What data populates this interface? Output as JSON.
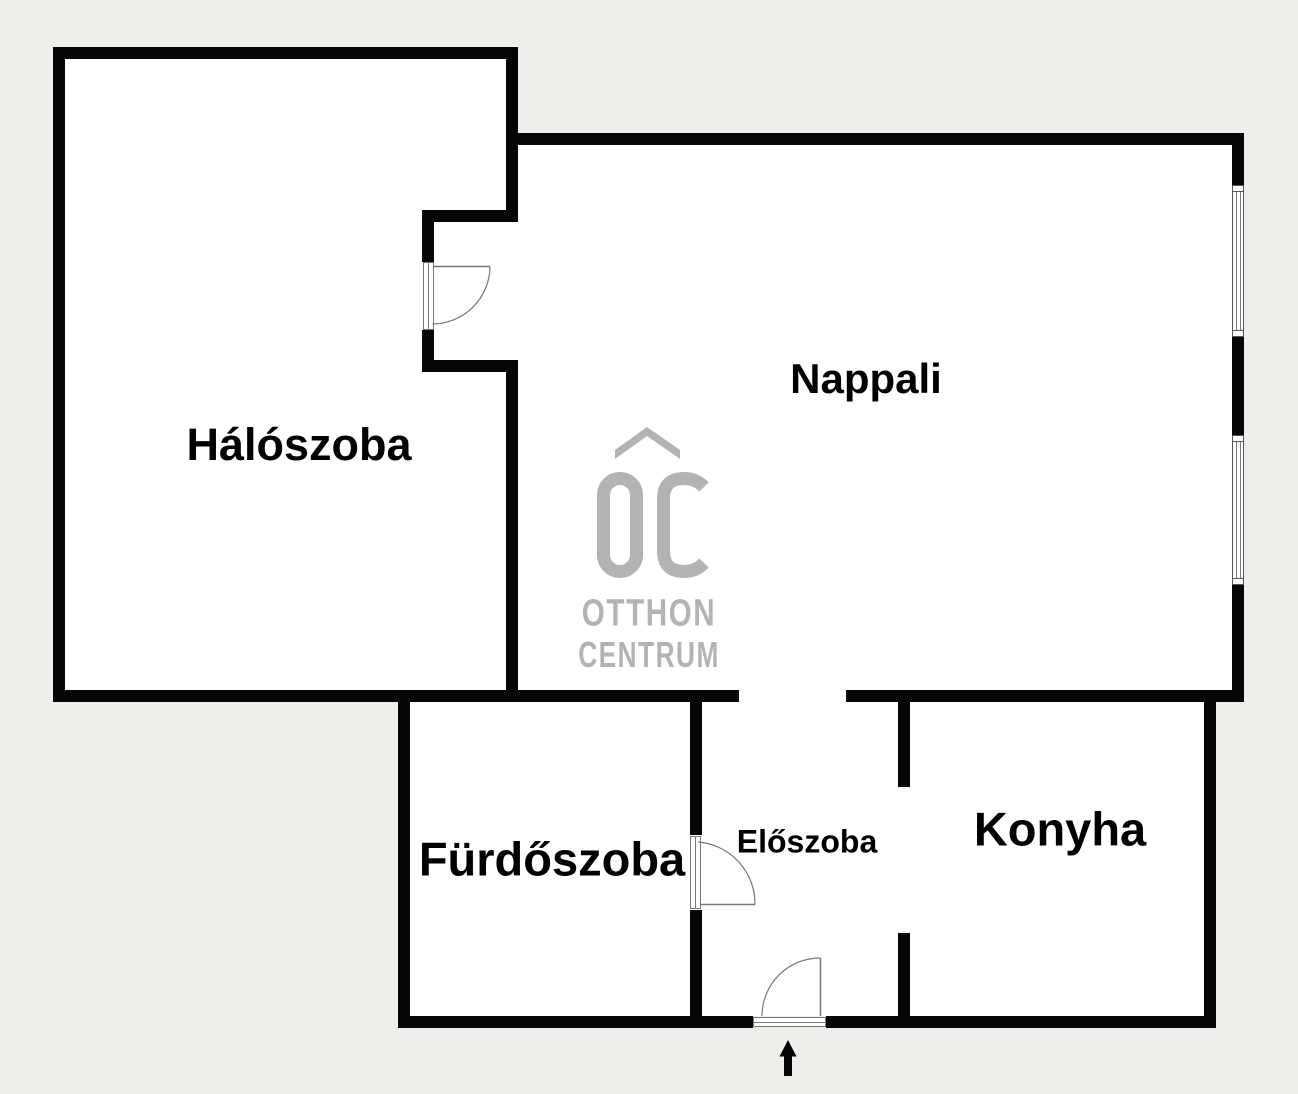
{
  "colors": {
    "background": "#efeeea",
    "wall": "#060606",
    "room": "#ffffff",
    "detail": "#777777",
    "logo": "#b4b3b1",
    "label": "#000000"
  },
  "rooms": [
    {
      "id": "haloszoba",
      "label": "Hálószoba",
      "cx": 299,
      "cy": 445,
      "font": 45
    },
    {
      "id": "nappali",
      "label": "Nappali",
      "cx": 866,
      "cy": 379,
      "font": 42
    },
    {
      "id": "furdoszoba",
      "label": "Fürdőszoba",
      "cx": 552,
      "cy": 859,
      "font": 47
    },
    {
      "id": "eloszoba",
      "label": "Előszoba",
      "cx": 807,
      "cy": 842,
      "font": 32
    },
    {
      "id": "konyha",
      "label": "Konyha",
      "cx": 1060,
      "cy": 829,
      "font": 47
    }
  ],
  "logo": {
    "monogram": "OC",
    "line1": "OTTHON",
    "line2": "CENTRUM"
  },
  "floorplan": {
    "width": 1298,
    "height": 1094,
    "fills": [
      {
        "n": "room-area-haloszoba",
        "x": 65,
        "y": 59,
        "w": 441,
        "h": 631
      },
      {
        "n": "room-area-nappali",
        "x": 506,
        "y": 145,
        "w": 726,
        "h": 545
      },
      {
        "n": "room-area-lower",
        "x": 410,
        "y": 702,
        "w": 794,
        "h": 314
      },
      {
        "n": "opening-nappali-eloszoba",
        "x": 739,
        "y": 690,
        "w": 107,
        "h": 12
      }
    ],
    "walls": [
      {
        "n": "wall-haloszoba-top",
        "x": 53,
        "y": 47,
        "w": 465,
        "h": 12
      },
      {
        "n": "wall-haloszoba-left",
        "x": 53,
        "y": 47,
        "w": 12,
        "h": 655
      },
      {
        "n": "wall-bottom-of-rooms-left",
        "x": 53,
        "y": 690,
        "w": 686,
        "h": 12
      },
      {
        "n": "wall-haloszoba-right-upper",
        "x": 506,
        "y": 47,
        "w": 12,
        "h": 175
      },
      {
        "n": "wall-recess-jut-top",
        "x": 422,
        "y": 210,
        "w": 96,
        "h": 12
      },
      {
        "n": "wall-recess-stub-top",
        "x": 422,
        "y": 210,
        "w": 12,
        "h": 52
      },
      {
        "n": "wall-recess-stub-bottom",
        "x": 422,
        "y": 330,
        "w": 12,
        "h": 42
      },
      {
        "n": "wall-recess-jut-bottom",
        "x": 422,
        "y": 360,
        "w": 96,
        "h": 12
      },
      {
        "n": "wall-haloszoba-right-lower",
        "x": 506,
        "y": 360,
        "w": 12,
        "h": 342
      },
      {
        "n": "wall-nappali-top",
        "x": 506,
        "y": 133,
        "w": 738,
        "h": 12
      },
      {
        "n": "wall-nappali-right-a",
        "x": 1232,
        "y": 133,
        "w": 12,
        "h": 52
      },
      {
        "n": "wall-nappali-right-b",
        "x": 1232,
        "y": 337,
        "w": 12,
        "h": 98
      },
      {
        "n": "wall-nappali-right-c",
        "x": 1232,
        "y": 585,
        "w": 12,
        "h": 117
      },
      {
        "n": "wall-bottom-of-rooms-right",
        "x": 846,
        "y": 690,
        "w": 398,
        "h": 12
      },
      {
        "n": "wall-furdoszoba-left",
        "x": 398,
        "y": 690,
        "w": 12,
        "h": 338
      },
      {
        "n": "wall-bottom-left",
        "x": 398,
        "y": 1016,
        "w": 355,
        "h": 12
      },
      {
        "n": "wall-bottom-right",
        "x": 826,
        "y": 1016,
        "w": 390,
        "h": 12
      },
      {
        "n": "wall-furdoszoba-right-upper",
        "x": 690,
        "y": 702,
        "w": 12,
        "h": 133
      },
      {
        "n": "wall-furdoszoba-right-lower",
        "x": 690,
        "y": 910,
        "w": 12,
        "h": 106
      },
      {
        "n": "wall-konyha-left-upper",
        "x": 898,
        "y": 702,
        "w": 12,
        "h": 85
      },
      {
        "n": "wall-konyha-left-lower",
        "x": 898,
        "y": 933,
        "w": 12,
        "h": 83
      },
      {
        "n": "wall-konyha-right",
        "x": 1204,
        "y": 690,
        "w": 12,
        "h": 338
      }
    ],
    "windows": [
      {
        "n": "window-nappali-upper",
        "x": 1232,
        "y": 185,
        "w": 12,
        "h": 152
      },
      {
        "n": "window-nappali-lower",
        "x": 1232,
        "y": 435,
        "w": 12,
        "h": 150
      }
    ],
    "doors": [
      {
        "n": "door-haloszoba-nappali",
        "x": 422.5,
        "y": 262,
        "w": 11,
        "h": 68,
        "dir": "v"
      },
      {
        "n": "door-furdoszoba-eloszoba",
        "x": 689.5,
        "y": 836,
        "w": 11,
        "h": 73,
        "dir": "v"
      },
      {
        "n": "door-entrance",
        "x": 753,
        "y": 1016.5,
        "w": 73,
        "h": 10,
        "dir": "h"
      }
    ],
    "door_lines": [
      {
        "n": "door-leaf-haloszoba",
        "x1": 433,
        "y1": 266.5,
        "x2": 490,
        "y2": 266.5
      },
      {
        "n": "door-leaf-furdoszoba",
        "x1": 700,
        "y1": 904.5,
        "x2": 755,
        "y2": 904.5
      },
      {
        "n": "door-leaf-entrance",
        "x1": 820.5,
        "y1": 958,
        "x2": 820.5,
        "y2": 1016
      }
    ],
    "door_arcs": [
      {
        "n": "door-arc-haloszoba",
        "d": "M 490 266.5 A 58 58 0 0 1 432.5 324"
      },
      {
        "n": "door-arc-furdoszoba",
        "d": "M 698 842 A 62 62 0 0 1 755 904.5"
      },
      {
        "n": "door-arc-entrance",
        "d": "M 762 1016 A 58 58 0 0 1 820.5 958"
      }
    ],
    "arrow_points": "788,1040 796.5,1056.5 792,1056.5 792,1076 784,1076 784,1056.5 779.5,1056.5"
  }
}
